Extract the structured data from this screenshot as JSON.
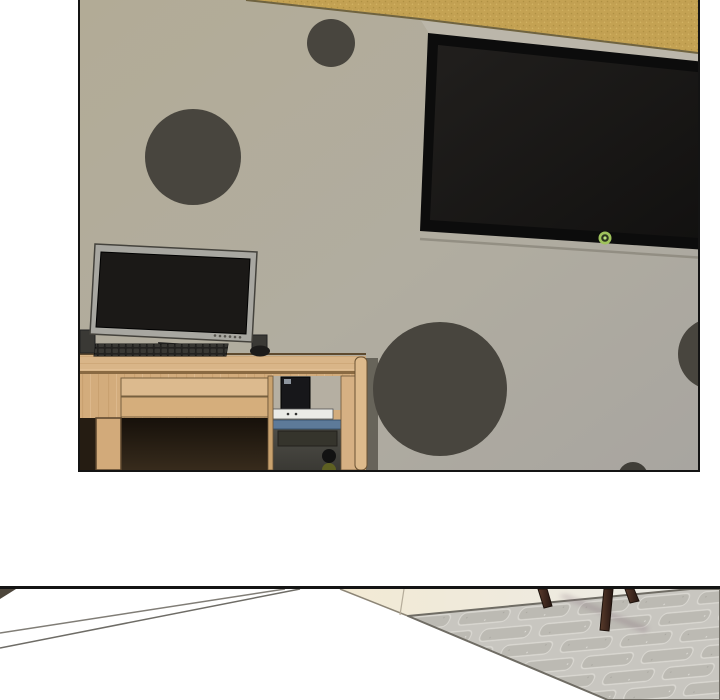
{
  "page": {
    "kind": "comic-strip-page",
    "background": "#ffffff",
    "panel_count": 2
  },
  "palette": {
    "gap_background": "#ffffff",
    "panel_border": "#141414",
    "wall": "#b2ab96",
    "gold_band": "#c4a253",
    "wall_dot": "#48453e",
    "tv_bezel": "#0c0c0c",
    "tv_screen": "#1a1817",
    "tv_power_light": "#a3c95c",
    "monitor_bezel": "#a8a7a1",
    "monitor_screen": "#1b1917",
    "keyboard": "#232220",
    "mouse": "#1c1b1a",
    "desk_wood": "#d8b287",
    "drawer_wood": "#dcba8e",
    "desk_leg": "#d2aa7a",
    "desk_interior_shadow": "#1d150d",
    "console_black": "#17171a",
    "media_player": "#ebebe7",
    "tower_body": "#4b4a45",
    "tower_stripe": "#5d7a99",
    "tower_inset": "#35342c",
    "tower_power_button": "#121212",
    "tower_second_button": "#5e6022",
    "floor_white": "#ffffff",
    "threshold_line": "#807d76",
    "doorway_cream": "#f2ead4",
    "rug_base": "#c8c6c0",
    "rug_brick": "#bcbab3",
    "rug_edge": "#6f6c64",
    "stool_leg": "#4a3326"
  },
  "panel1": {
    "name": "bedroom-wall-scene",
    "objects": [
      "polka-dot-wall",
      "gold-ceiling-band",
      "wall-mounted-tv",
      "tv-power-light",
      "computer-desk",
      "desktop-monitor",
      "monitor-buttons",
      "keyboard",
      "mouse",
      "desk-speakers",
      "desk-drawers",
      "game-console",
      "media-player",
      "pc-tower",
      "wall-dots-five"
    ]
  },
  "panel2": {
    "name": "floor-scene",
    "objects": [
      "white-floor",
      "floor-threshold-lines",
      "doorway-cream-floor",
      "textured-rug",
      "stool-legs-three",
      "leg-shadow"
    ]
  }
}
